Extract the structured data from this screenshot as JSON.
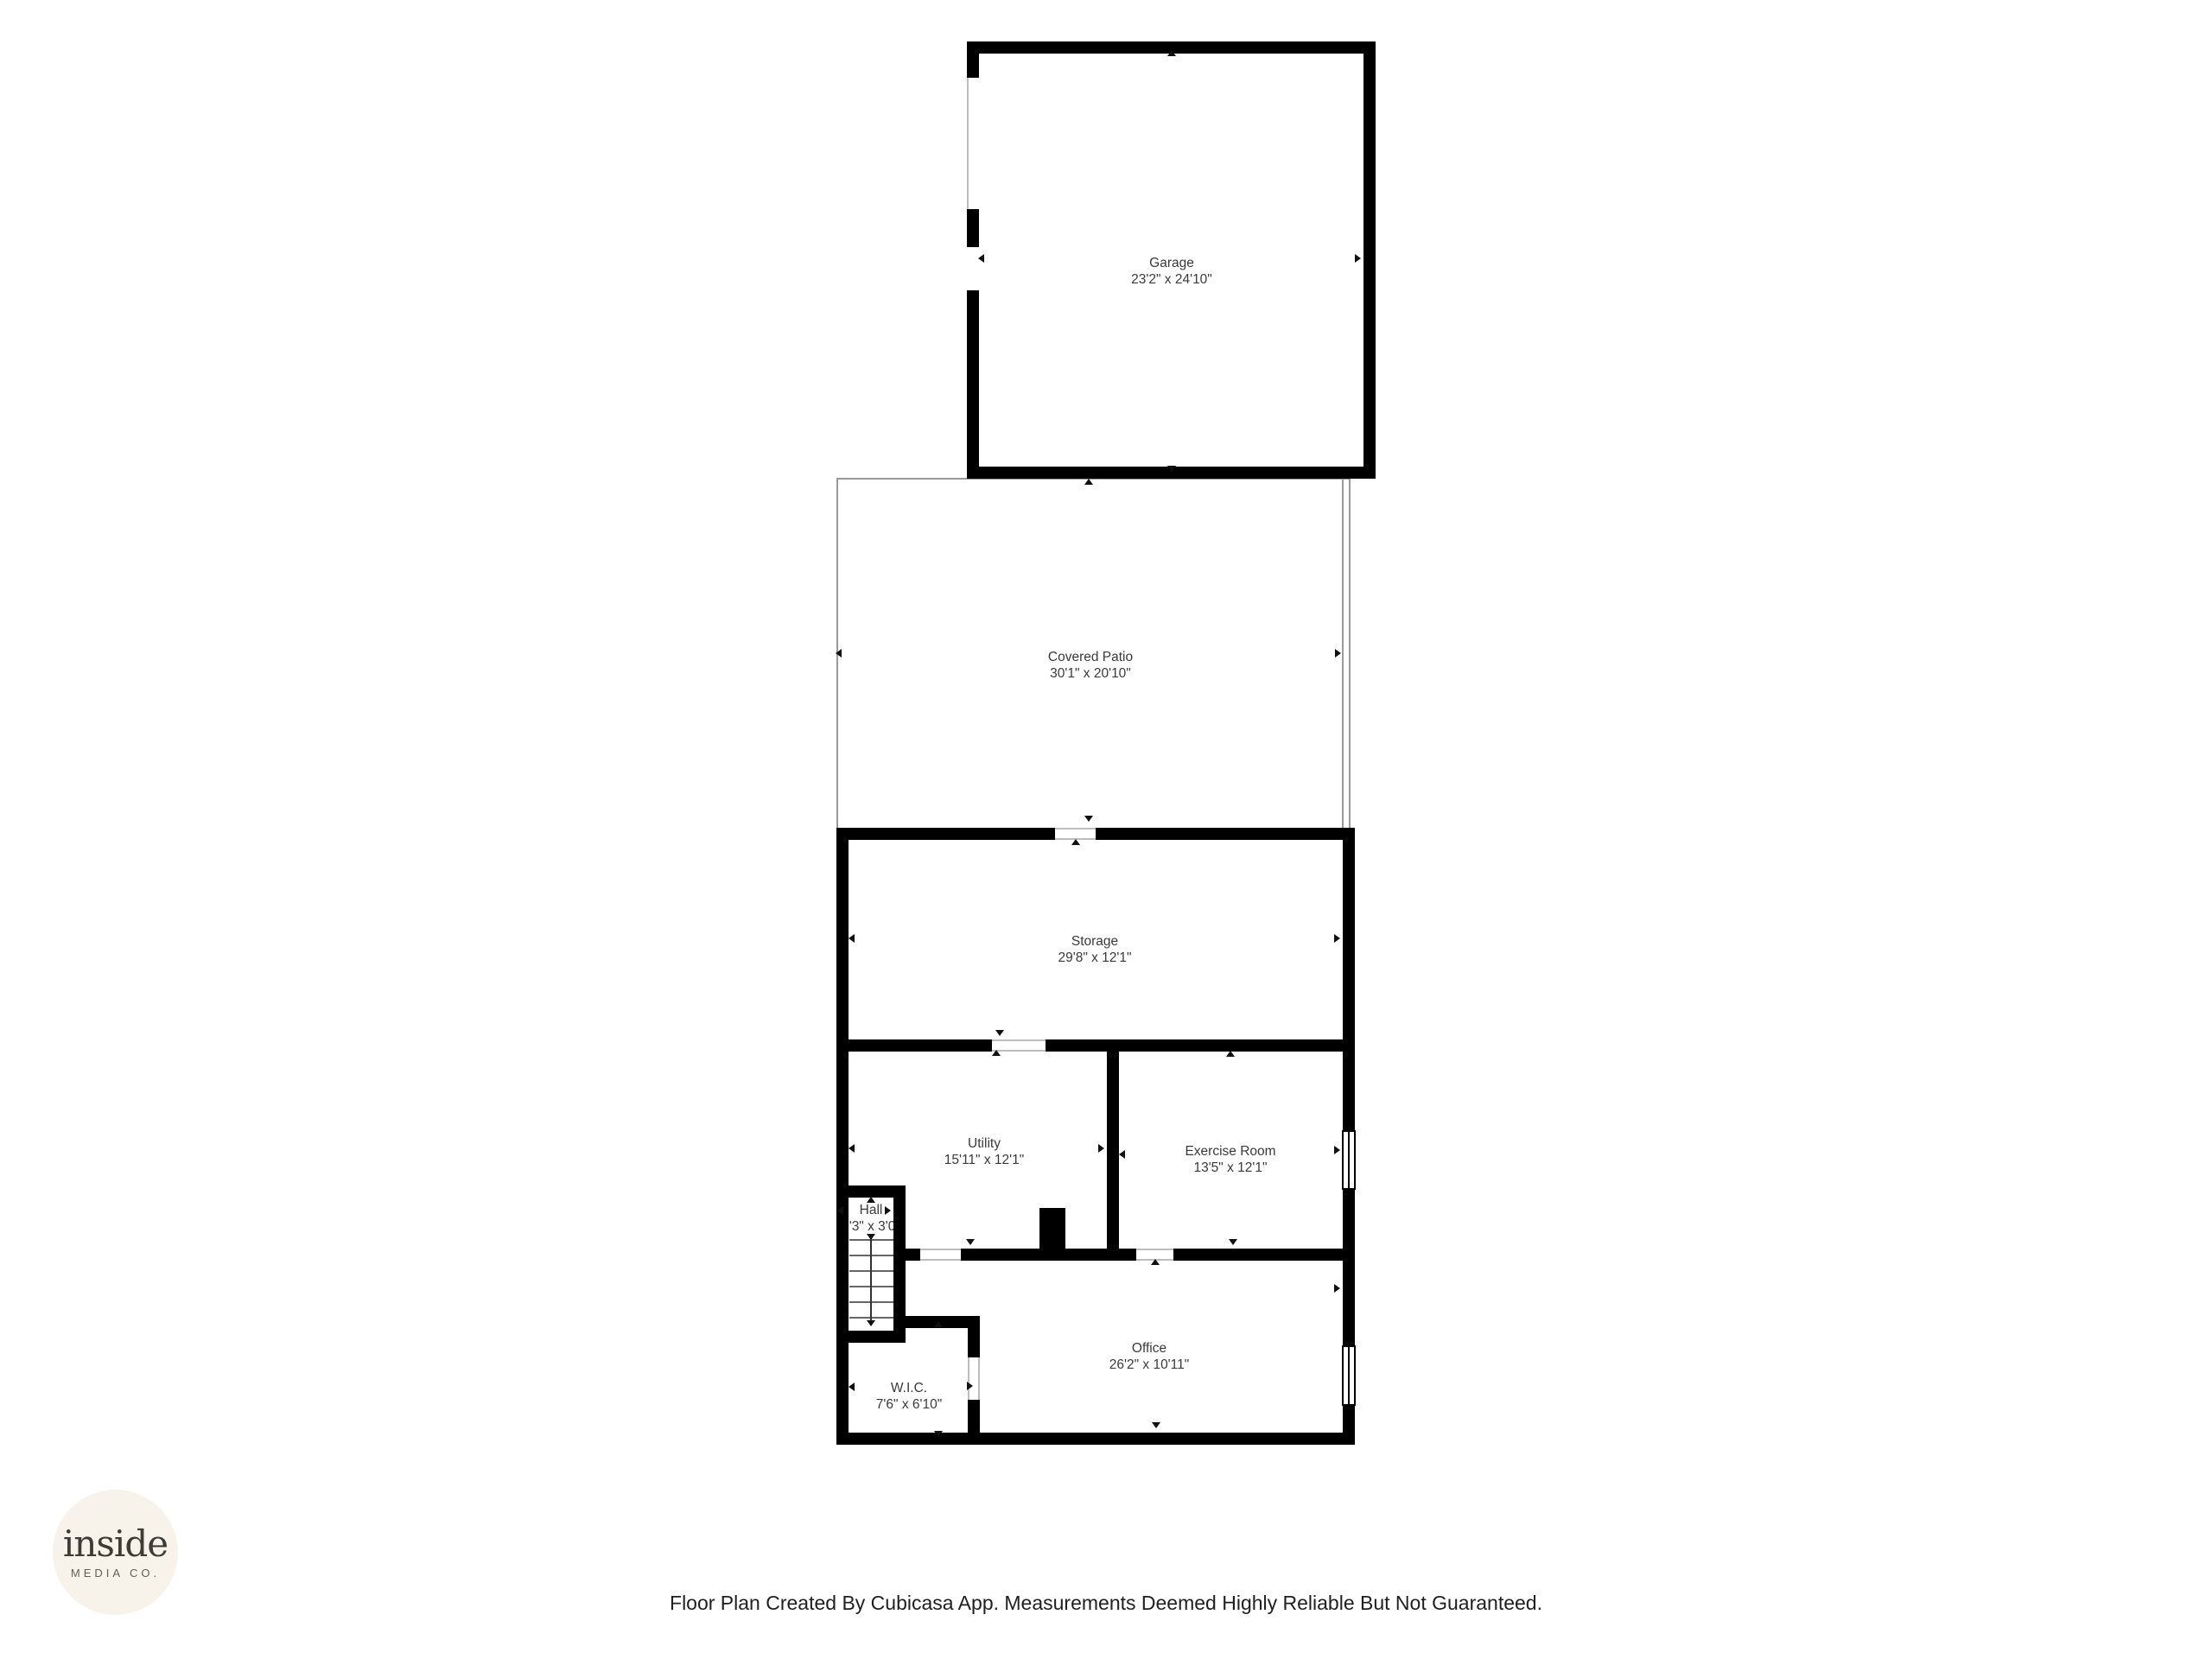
{
  "rooms": {
    "garage": {
      "name": "Garage",
      "dims": "23'2\" x 24'10\""
    },
    "covered_patio": {
      "name": "Covered Patio",
      "dims": "30'1\" x 20'10\""
    },
    "storage": {
      "name": "Storage",
      "dims": "29'8\" x 12'1\""
    },
    "utility": {
      "name": "Utility",
      "dims": "15'11\" x 12'1\""
    },
    "exercise_room": {
      "name": "Exercise Room",
      "dims": "13'5\" x 12'1\""
    },
    "hall": {
      "name": "Hall",
      "dims": "3'3\" x 3'0\""
    },
    "office": {
      "name": "Office",
      "dims": "26'2\" x 10'11\""
    },
    "wic": {
      "name": "W.I.C.",
      "dims": "7'6\" x 6'10\""
    }
  },
  "branding": {
    "logo_text": "inside",
    "logo_subtext": "MEDIA CO."
  },
  "footer": {
    "disclaimer": "Floor Plan Created By Cubicasa App. Measurements Deemed Highly Reliable But Not Guaranteed."
  },
  "colors": {
    "wall": "#000000",
    "patio_outline": "#9a9a9a",
    "opening_line": "#bdbdbd",
    "label_text": "#3a3a3a",
    "logo_background": "#f7f3ea",
    "logo_text": "#3d3d35",
    "logo_subtext": "#5f5f58",
    "footer_text": "#1f1f1f"
  }
}
